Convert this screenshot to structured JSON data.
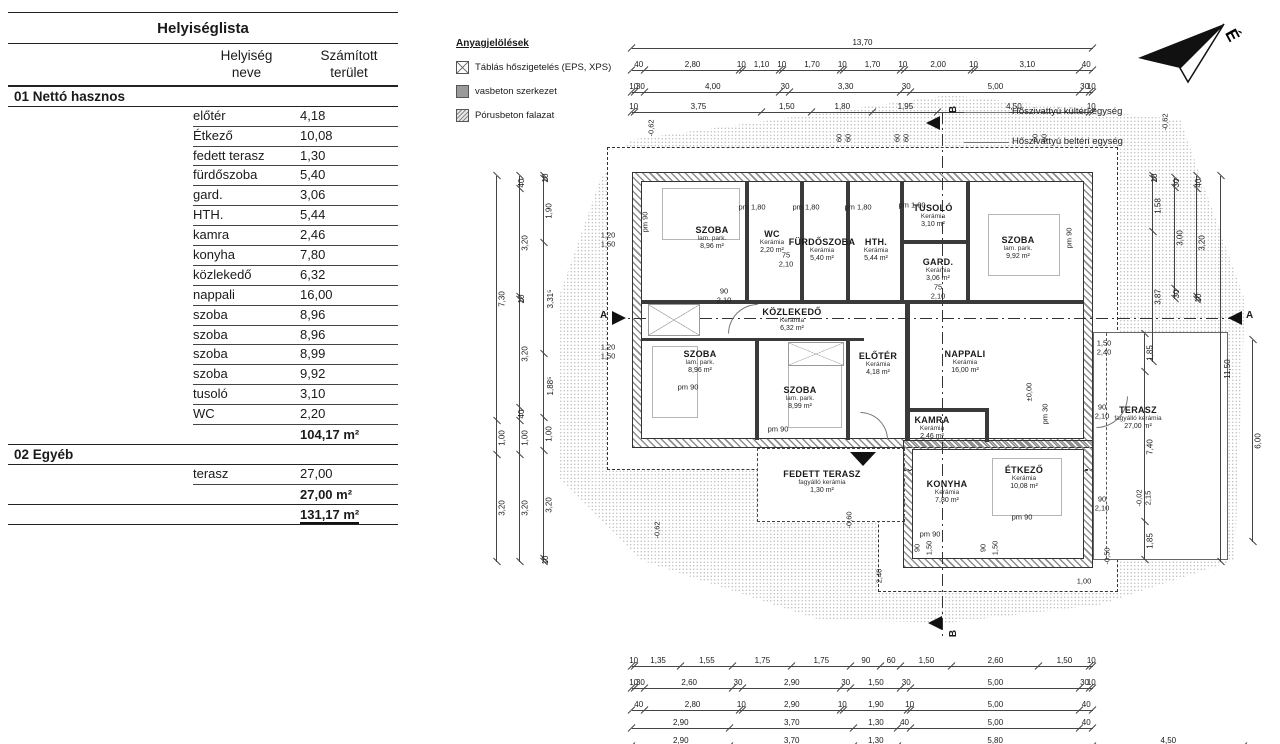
{
  "table": {
    "title": "Helyiséglista",
    "headers": {
      "name": [
        "Helyiség",
        "neve"
      ],
      "area": [
        "Számított",
        "terület"
      ]
    },
    "sections": [
      {
        "label": "01 Nettó hasznos",
        "rows": [
          [
            "előtér",
            "4,18"
          ],
          [
            "Étkező",
            "10,08"
          ],
          [
            "fedett terasz",
            "1,30"
          ],
          [
            "fürdőszoba",
            "5,40"
          ],
          [
            "gard.",
            "3,06"
          ],
          [
            "HTH.",
            "5,44"
          ],
          [
            "kamra",
            "2,46"
          ],
          [
            "konyha",
            "7,80"
          ],
          [
            "közlekedő",
            "6,32"
          ],
          [
            "nappali",
            "16,00"
          ],
          [
            "szoba",
            "8,96"
          ],
          [
            "szoba",
            "8,96"
          ],
          [
            "szoba",
            "8,99"
          ],
          [
            "szoba",
            "9,92"
          ],
          [
            "tusoló",
            "3,10"
          ],
          [
            "WC",
            "2,20"
          ]
        ],
        "subtotal": "104,17 m²"
      },
      {
        "label": "02 Egyéb",
        "rows": [
          [
            "terasz",
            "27,00"
          ]
        ],
        "subtotal": "27,00 m²"
      }
    ],
    "grand_total": "131,17 m²"
  },
  "legend": {
    "title": "Anyagjelölések",
    "items": [
      {
        "swatch": "insulation-board",
        "label": "Táblás hőszigetelés (EPS, XPS)"
      },
      {
        "swatch": "reinforced-concrete",
        "label": "vasbeton szerkezet"
      },
      {
        "swatch": "aerated-concrete",
        "label": "Pórusbeton falazat"
      }
    ]
  },
  "annotations": {
    "heat_pump_outdoor": "Hőszivattyú kültéri egység",
    "heat_pump_indoor": "Hőszivattyú beltéri egység",
    "north_letter": "É",
    "section_a": "A",
    "section_b": "B"
  },
  "plan": {
    "rooms": [
      {
        "name": "SZOBA",
        "material": "lam. park.",
        "area": "8,96 m²"
      },
      {
        "name": "WC",
        "material": "Kerámia",
        "area": "2,20 m²"
      },
      {
        "name": "FÜRDŐSZOBA",
        "material": "Kerámia",
        "area": "5,40 m²"
      },
      {
        "name": "HTH.",
        "material": "Kerámia",
        "area": "5,44 m²"
      },
      {
        "name": "TUSOLÓ",
        "material": "Kerámia",
        "area": "3,10 m²"
      },
      {
        "name": "GARD.",
        "material": "Kerámia",
        "area": "3,06 m²"
      },
      {
        "name": "SZOBA",
        "material": "lam. park.",
        "area": "9,92 m²"
      },
      {
        "name": "KÖZLEKEDŐ",
        "material": "Kerámia",
        "area": "6,32 m²"
      },
      {
        "name": "SZOBA",
        "material": "lam. park.",
        "area": "8,96 m²"
      },
      {
        "name": "SZOBA",
        "material": "lam. park.",
        "area": "8,99 m²"
      },
      {
        "name": "ELŐTÉR",
        "material": "Kerámia",
        "area": "4,18 m²"
      },
      {
        "name": "NAPPALI",
        "material": "Kerámia",
        "area": "16,00 m²"
      },
      {
        "name": "KAMRA",
        "material": "Kerámia",
        "area": "2,46 m²"
      },
      {
        "name": "KONYHA",
        "material": "Kerámia",
        "area": "7,80 m²"
      },
      {
        "name": "ÉTKEZŐ",
        "material": "Kerámia",
        "area": "10,08 m²"
      },
      {
        "name": "FEDETT TERASZ",
        "material": "fagyálló kerámia",
        "area": "1,30 m²"
      },
      {
        "name": "TERASZ",
        "material": "fagyálló kerámia",
        "area": "27,00 m²"
      }
    ],
    "tags": [
      "pm 1,80",
      "pm 1,80",
      "pm 1,80",
      "pm 1,80",
      "pm 90",
      "pm 90",
      "pm 90",
      "pm 90",
      "pm 90",
      "pm 90",
      "pm 30",
      "90\n2,10",
      "75\n2,10",
      "75\n2,10",
      "1,50\n2,40",
      "90\n2,10",
      "90\n2,10",
      "1,20\n1,50",
      "1,20\n1,50",
      "±0,00",
      "-0,62",
      "-0,62",
      "-0,60",
      "-0,62",
      "-0,50",
      "-0,02\n2,15",
      "2,40",
      "1,00",
      "90",
      "1,50",
      "90",
      "1,50",
      "60\n60",
      "60\n60",
      "60\n60"
    ]
  },
  "dims": {
    "top": [
      [
        "13,70"
      ],
      [
        "40",
        "2,80",
        "10",
        "1,10",
        "10",
        "1,70",
        "10",
        "1,70",
        "10",
        "2,00",
        "10",
        "3,10",
        "40"
      ],
      [
        "10",
        "30",
        "4,00",
        "30",
        "3,30",
        "30",
        "5,00",
        "30",
        "10"
      ],
      [
        "10",
        "3,75",
        "1,50",
        "1,80",
        "1,95",
        "4,50",
        "10"
      ]
    ],
    "bottom": [
      [
        "10",
        "1,35",
        "1,55",
        "1,75",
        "1,75",
        "90",
        "60",
        "1,50",
        "2,60",
        "1,50",
        "10"
      ],
      [
        "10",
        "30",
        "2,60",
        "30",
        "2,90",
        "30",
        "1,50",
        "30",
        "5,00",
        "30",
        "10"
      ],
      [
        "40",
        "2,80",
        "10",
        "2,90",
        "10",
        "1,90",
        "10",
        "5,00",
        "40"
      ],
      [
        "2,90",
        "3,70",
        "1,30",
        "40",
        "5,00",
        "40"
      ],
      [
        "2,90",
        "3,70",
        "1,30",
        "5,80",
        "4,50"
      ]
    ],
    "left": [
      [
        "7,30",
        "1,00",
        "3,20"
      ],
      [
        "40",
        "3,20",
        "10",
        "3,20",
        "40",
        "1,00",
        "3,20"
      ],
      [
        "10",
        "1,90",
        "3,31⁵",
        "1,88⁵",
        "1,00",
        "3,20",
        "10"
      ]
    ],
    "right": [
      [
        "10",
        "1,58",
        "3,87"
      ],
      [
        "30",
        "3,00",
        "30"
      ],
      [
        "40",
        "3,20",
        "10"
      ],
      [
        "11,50"
      ],
      [
        "1,85",
        "7,40",
        "1,85"
      ],
      [
        "6,00"
      ]
    ]
  }
}
